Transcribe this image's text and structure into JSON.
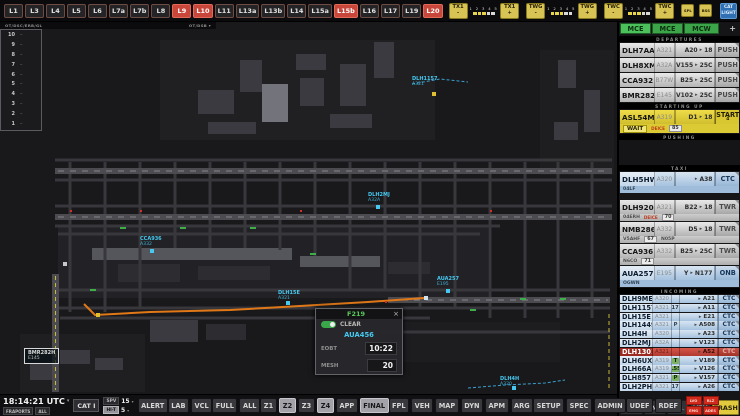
{
  "topbar": {
    "lights": [
      {
        "label": "L1",
        "active": false
      },
      {
        "label": "L3",
        "active": false
      },
      {
        "label": "L4",
        "active": false
      },
      {
        "label": "L5",
        "active": false
      },
      {
        "label": "L6",
        "active": false
      },
      {
        "label": "L7a",
        "active": false
      },
      {
        "label": "L7b",
        "active": false
      },
      {
        "label": "L8",
        "active": false
      },
      {
        "label": "L9",
        "active": true
      },
      {
        "label": "L10",
        "active": true
      },
      {
        "label": "L11",
        "active": false
      },
      {
        "label": "L13a",
        "active": false
      },
      {
        "label": "L13b",
        "active": false
      },
      {
        "label": "L14",
        "active": false
      },
      {
        "label": "L15a",
        "active": false
      },
      {
        "label": "L15b",
        "active": true
      },
      {
        "label": "L16",
        "active": false
      },
      {
        "label": "L17",
        "active": false
      },
      {
        "label": "L19",
        "active": false
      },
      {
        "label": "L20",
        "active": true
      }
    ],
    "brightness_groups": [
      {
        "name": "TX1",
        "minus": "-",
        "plus": "+",
        "scale": "1 2 3 4 5",
        "levels": [
          true,
          true,
          true,
          false,
          false
        ]
      },
      {
        "name": "TWG",
        "minus": "-",
        "plus": "+",
        "scale": "1 2 3 4 5",
        "levels": [
          true,
          true,
          true,
          false,
          false
        ]
      },
      {
        "name": "TWC",
        "minus": "-",
        "plus": "+",
        "scale": "1 2 3 4 5",
        "levels": [
          true,
          true,
          true,
          false,
          false
        ]
      }
    ],
    "extra_buttons": [
      {
        "label": "SPL"
      },
      {
        "label": "BSS"
      }
    ],
    "cat_light_label": "CAT LIGHT"
  },
  "map": {
    "band_left": "OT/DSC/ERB/GL",
    "band_right": "OT/DSB",
    "band_caret": "▾",
    "scale_numbers": [
      "10",
      "9",
      "8",
      "7",
      "6",
      "5",
      "4",
      "3",
      "2",
      "1"
    ],
    "boxed_labels": [
      {
        "line1": "DLH61A",
        "line2": "A319 S26",
        "x": 2,
        "y": 64,
        "color": "#46c8f0"
      },
      {
        "line1": "BMR282H",
        "line2": "E145",
        "x": 24,
        "y": 326,
        "color": "#d8d8d8"
      }
    ],
    "labels": [
      {
        "line1": "CCA936",
        "line2": "A332",
        "x": 140,
        "y": 214
      },
      {
        "line1": "DLH15E",
        "line2": "A321",
        "x": 278,
        "y": 268
      },
      {
        "line1": "DLH2MJ",
        "line2": "A32A",
        "x": 368,
        "y": 170
      },
      {
        "line1": "DLH1157",
        "line2": "A321",
        "x": 412,
        "y": 54
      },
      {
        "line1": "AUA257",
        "line2": "E195",
        "x": 437,
        "y": 254
      },
      {
        "line1": "DLH4H",
        "line2": "A320",
        "x": 500,
        "y": 354
      }
    ],
    "markers": [
      {
        "x": 432,
        "y": 70,
        "c": "#e0c030"
      },
      {
        "x": 96,
        "y": 291,
        "c": "#e0c030"
      },
      {
        "x": 150,
        "y": 227,
        "c": "#46c8f0"
      },
      {
        "x": 286,
        "y": 279,
        "c": "#46c8f0"
      },
      {
        "x": 376,
        "y": 183,
        "c": "#46c8f0"
      },
      {
        "x": 446,
        "y": 267,
        "c": "#46c8f0"
      },
      {
        "x": 424,
        "y": 274,
        "c": "#d0e4f0"
      },
      {
        "x": 512,
        "y": 364,
        "c": "#46c8f0"
      },
      {
        "x": 63,
        "y": 240,
        "c": "#c8c8c8"
      }
    ],
    "popup": {
      "title": "F219",
      "close": "×",
      "toggle_label": "CLEAR",
      "callsign": "AUA456",
      "rows": [
        {
          "label": "EOBT",
          "value": "10:22"
        },
        {
          "label": "MESH",
          "value": "20"
        }
      ]
    }
  },
  "strip_panel": {
    "tabs": [
      {
        "label": "MCE",
        "active": true
      },
      {
        "label": "MCE",
        "active": false
      },
      {
        "label": "MCW",
        "active": false
      }
    ],
    "plus_label": "+",
    "sections": [
      {
        "title": "DEPARTURES",
        "strips": [
          {
            "cs": "DLH7AA",
            "type": "A321",
            "from": "A20",
            "to": "18",
            "btn": "PUSH",
            "style": "gray"
          },
          {
            "cs": "DLH8XM",
            "type": "A32A",
            "from": "V155",
            "to": "25C",
            "btn": "PUSH",
            "style": "gray"
          },
          {
            "cs": "CCA932",
            "type": "B77W",
            "from": "B25",
            "to": "25C",
            "btn": "PUSH",
            "style": "gray"
          },
          {
            "cs": "BMR282H",
            "type": "E145",
            "from": "V102",
            "to": "25C",
            "btn": "PUSH",
            "style": "gray"
          }
        ]
      },
      {
        "title": "STARTING UP",
        "strips": [
          {
            "cs": "ASL54M",
            "type": "A319",
            "from": "D1",
            "to": "18",
            "btn": "START",
            "btn_sub": "4",
            "style": "yellow",
            "sub": [
              {
                "t": "WAIT",
                "k": "chip"
              },
              {
                "t": "DEICE",
                "k": "red"
              },
              {
                "t": "85",
                "k": "box"
              }
            ]
          }
        ]
      },
      {
        "title": "PUSHING",
        "bay": 24,
        "strips": []
      },
      {
        "title": "TAXI",
        "strips": [
          {
            "cs": "DLH5HW",
            "type": "A320",
            "tag": "P",
            "to": "A38",
            "btn": "CTC",
            "style": "blue",
            "gap_after": 6,
            "sub": [
              {
                "t": "04LF",
                "k": "plain"
              }
            ]
          },
          {
            "cs": "DLH920",
            "type": "A321",
            "from": "B22",
            "to": "18",
            "btn": "TWR",
            "style": "gray",
            "sub": [
              {
                "t": "04ERH",
                "k": "plain"
              },
              {
                "t": "DEICE",
                "k": "red"
              },
              {
                "t": "70",
                "k": "box"
              }
            ]
          },
          {
            "cs": "NMB286",
            "type": "A332",
            "from": "D5",
            "to": "18",
            "btn": "TWR",
            "style": "gray",
            "sub": [
              {
                "t": "V5AHF",
                "k": "plain"
              },
              {
                "t": "67",
                "k": "box"
              },
              {
                "t": "N05P",
                "k": "plain"
              }
            ]
          },
          {
            "cs": "CCA936",
            "type": "A332",
            "from": "B25",
            "to": "25C",
            "btn": "TWR",
            "style": "gray",
            "sub": [
              {
                "t": "N6CO",
                "k": "plain"
              },
              {
                "t": "71",
                "k": "box"
              }
            ]
          },
          {
            "cs": "AUA257",
            "type": "E195",
            "from": "Y",
            "to": "N177",
            "btn": "ONB",
            "style": "blue",
            "sub": [
              {
                "t": "OGWN",
                "k": "plain"
              }
            ]
          }
        ]
      },
      {
        "title": "INCOMING",
        "compact": true,
        "strips": [
          {
            "cs": "DLH9ME",
            "type": "A320",
            "to": "A21",
            "btn": "CTC",
            "style": "blue"
          },
          {
            "cs": "DLH1157",
            "type": "A321",
            "tag": "L17R",
            "to": "A11",
            "btn": "CTC",
            "style": "blue"
          },
          {
            "cs": "DLH15E",
            "type": "A321",
            "to": "E21",
            "btn": "CTC",
            "style": "blue"
          },
          {
            "cs": "DLH1449",
            "type": "A321",
            "tag": "P",
            "to": "A508",
            "btn": "CTC",
            "style": "blue"
          },
          {
            "cs": "DLH4H",
            "type": "A320",
            "to": "A23",
            "btn": "CTC",
            "style": "blue"
          },
          {
            "cs": "DLH2MJ",
            "type": "A32A",
            "to": "V123",
            "btn": "CTC",
            "style": "blue"
          },
          {
            "cs": "DLH1301",
            "type": "A321",
            "to": "A52",
            "btn": "CTC",
            "style": "red"
          },
          {
            "cs": "DLH6UX",
            "type": "A319",
            "tag": "T",
            "tag_green": true,
            "to": "V189",
            "btn": "CTC",
            "style": "blue"
          },
          {
            "cs": "DLH66A",
            "type": "A319",
            "tag": "L55",
            "tag_green": true,
            "to": "V126",
            "btn": "CTC",
            "style": "blue"
          },
          {
            "cs": "DLH857",
            "type": "A321",
            "tag": "P",
            "tag_green": true,
            "to": "V157",
            "btn": "CTC",
            "style": "blue"
          },
          {
            "cs": "DLH2PH",
            "type": "A321",
            "tag": "L17R",
            "to": "A26",
            "btn": "CTC",
            "style": "blue"
          }
        ]
      }
    ],
    "footer": [
      {
        "label": "UNDO"
      },
      {
        "label": "INF"
      },
      {
        "label": "FPL",
        "dim": true
      },
      {
        "label": "VEH"
      },
      {
        "label": "TRASH",
        "yellow": true
      }
    ]
  },
  "bottom_bar": {
    "time": "18:14:21 UTC",
    "time_caret": "▾",
    "time_chips": [
      {
        "label": "FRAPORTS"
      },
      {
        "label": "ALL"
      }
    ],
    "cat_label": "CAT I",
    "spv": {
      "label": "SPV",
      "value": "15",
      "caret": "▾"
    },
    "hit": {
      "label": "HI-T",
      "value": "5",
      "caret": "▾"
    },
    "groups": [
      {
        "buttons": [
          {
            "label": "ALERT"
          }
        ]
      },
      {
        "buttons": [
          {
            "label": "LAB"
          },
          {
            "label": "VCL"
          }
        ]
      },
      {
        "buttons": [
          {
            "label": "FULL"
          },
          {
            "label": "ALL"
          }
        ]
      },
      {
        "buttons": [
          {
            "label": "Z1"
          },
          {
            "label": "Z2",
            "active": true
          },
          {
            "label": "Z3"
          },
          {
            "label": "Z4",
            "active": true
          },
          {
            "label": "APP"
          },
          {
            "label": "FINAL",
            "active": true
          }
        ]
      },
      {
        "buttons": [
          {
            "label": "FPL"
          },
          {
            "label": "VEH"
          },
          {
            "label": "MAP"
          },
          {
            "label": "DYN"
          },
          {
            "label": "APM"
          },
          {
            "label": "ARG"
          }
        ]
      },
      {
        "buttons": [
          {
            "label": "SETUP"
          },
          {
            "label": "SPEC"
          },
          {
            "label": "ADMIN"
          }
        ]
      },
      {
        "buttons": [
          {
            "label": "UDEF"
          },
          {
            "label": "RDEF"
          }
        ]
      }
    ],
    "alert_grid": [
      {
        "label": "LVO"
      },
      {
        "label": "RLZ"
      },
      {
        "label": "EMG"
      },
      {
        "label": "ADES"
      }
    ]
  },
  "colors": {
    "accent_red": "#c8473a",
    "accent_yellow": "#d8c455",
    "strip_blue": "#b9d0e8",
    "strip_yellow": "#e6d43c",
    "alert_red": "#c43a2e",
    "cyan": "#46c8f0",
    "route_orange": "#e07818",
    "tab_green": "#3da549"
  }
}
